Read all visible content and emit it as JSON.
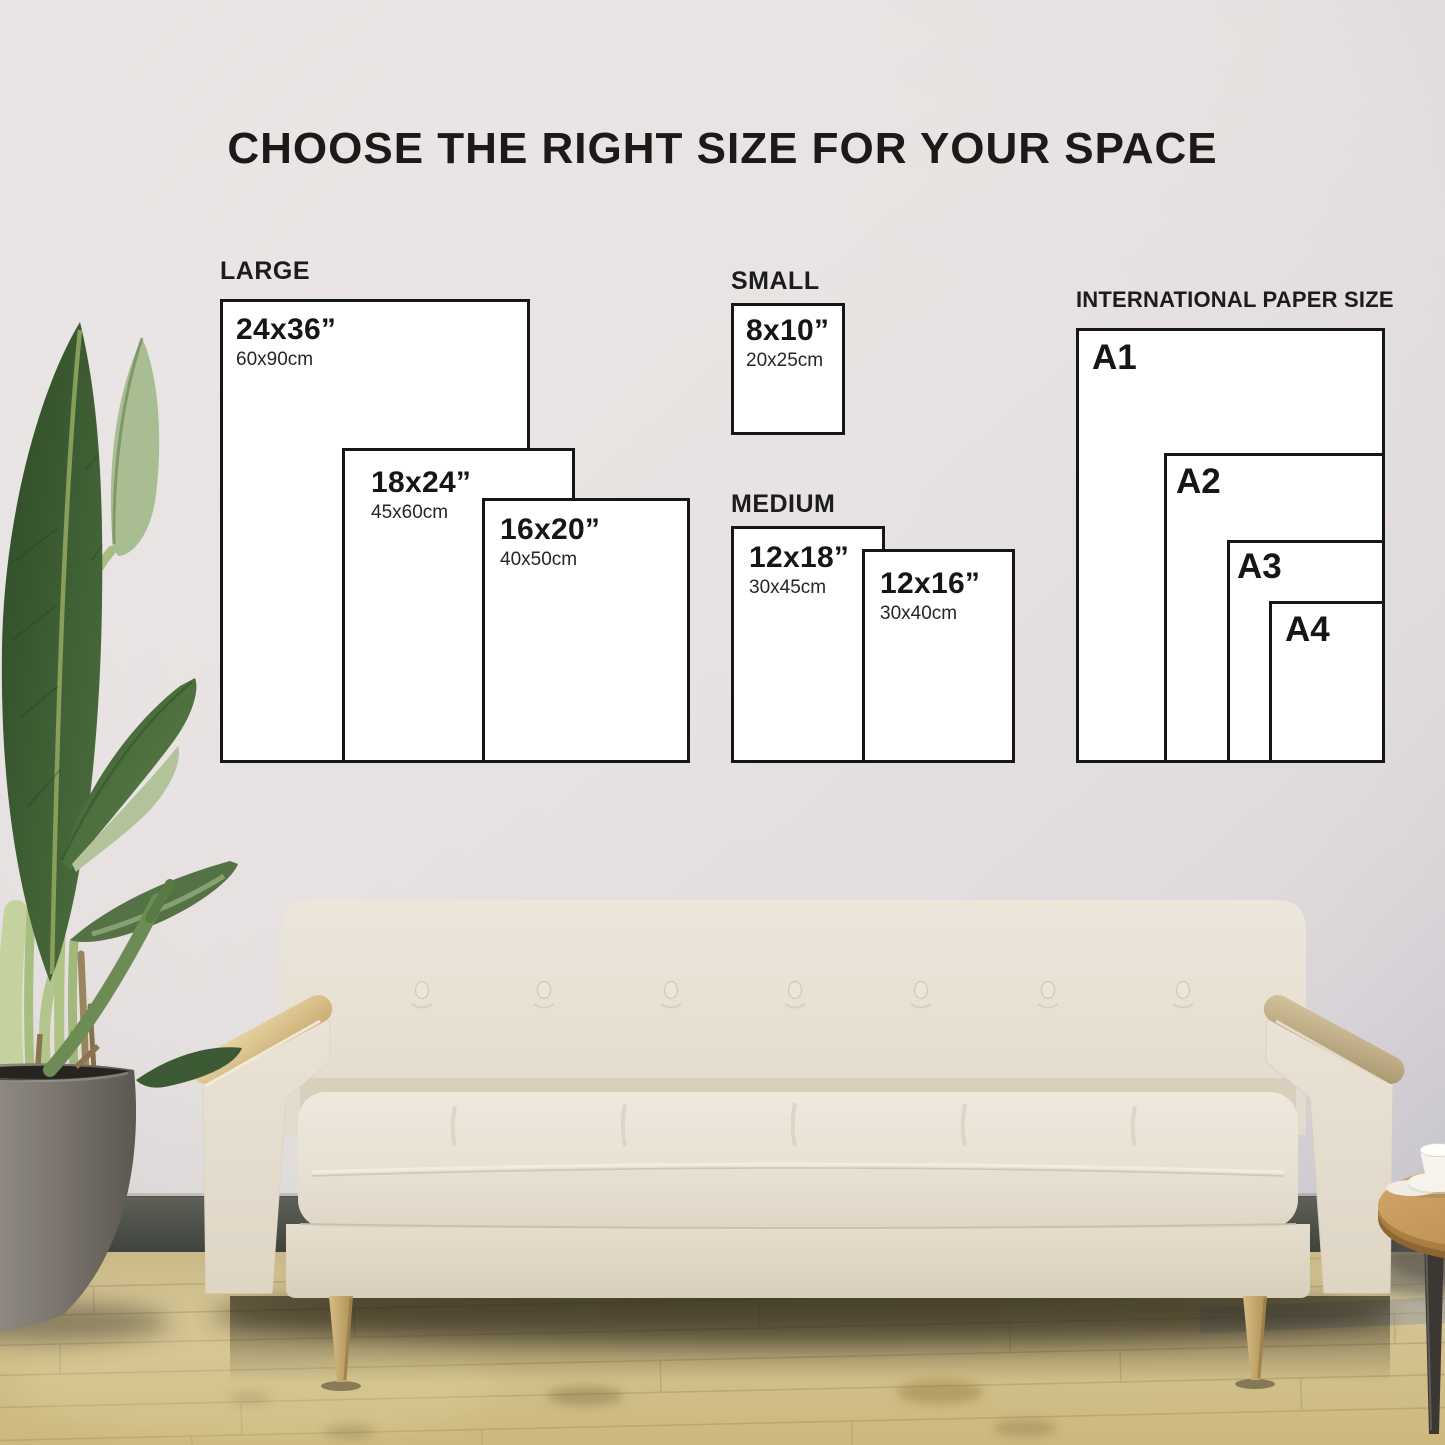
{
  "title": "CHOOSE THE RIGHT SIZE FOR YOUR SPACE",
  "groups": {
    "large": {
      "label": "LARGE",
      "sizes": [
        {
          "inches": "24x36”",
          "cm": "60x90cm"
        },
        {
          "inches": "18x24”",
          "cm": "45x60cm"
        },
        {
          "inches": "16x20”",
          "cm": "40x50cm"
        }
      ]
    },
    "small": {
      "label": "SMALL",
      "sizes": [
        {
          "inches": "8x10”",
          "cm": "20x25cm"
        }
      ]
    },
    "medium": {
      "label": "MEDIUM",
      "sizes": [
        {
          "inches": "12x18”",
          "cm": "30x45cm"
        },
        {
          "inches": "12x16”",
          "cm": "30x40cm"
        }
      ]
    },
    "international": {
      "label": "INTERNATIONAL PAPER SIZE",
      "sizes": [
        {
          "name": "A1"
        },
        {
          "name": "A2"
        },
        {
          "name": "A3"
        },
        {
          "name": "A4"
        }
      ]
    }
  },
  "scene": {
    "objects": [
      "wall",
      "wood-floor",
      "skirting-board",
      "potted-plant",
      "sofa",
      "side-table-with-cup"
    ],
    "palette": {
      "wall": "#e8e3e2",
      "floor": "#d2c28e",
      "sofa_fabric": "#e9e2d5",
      "wood_accent": "#d9c18c",
      "leaf_green": "#4a6b3c",
      "pot_gray": "#85807a",
      "paper": "#ffffff",
      "outline": "#161616",
      "text": "#141414"
    }
  }
}
